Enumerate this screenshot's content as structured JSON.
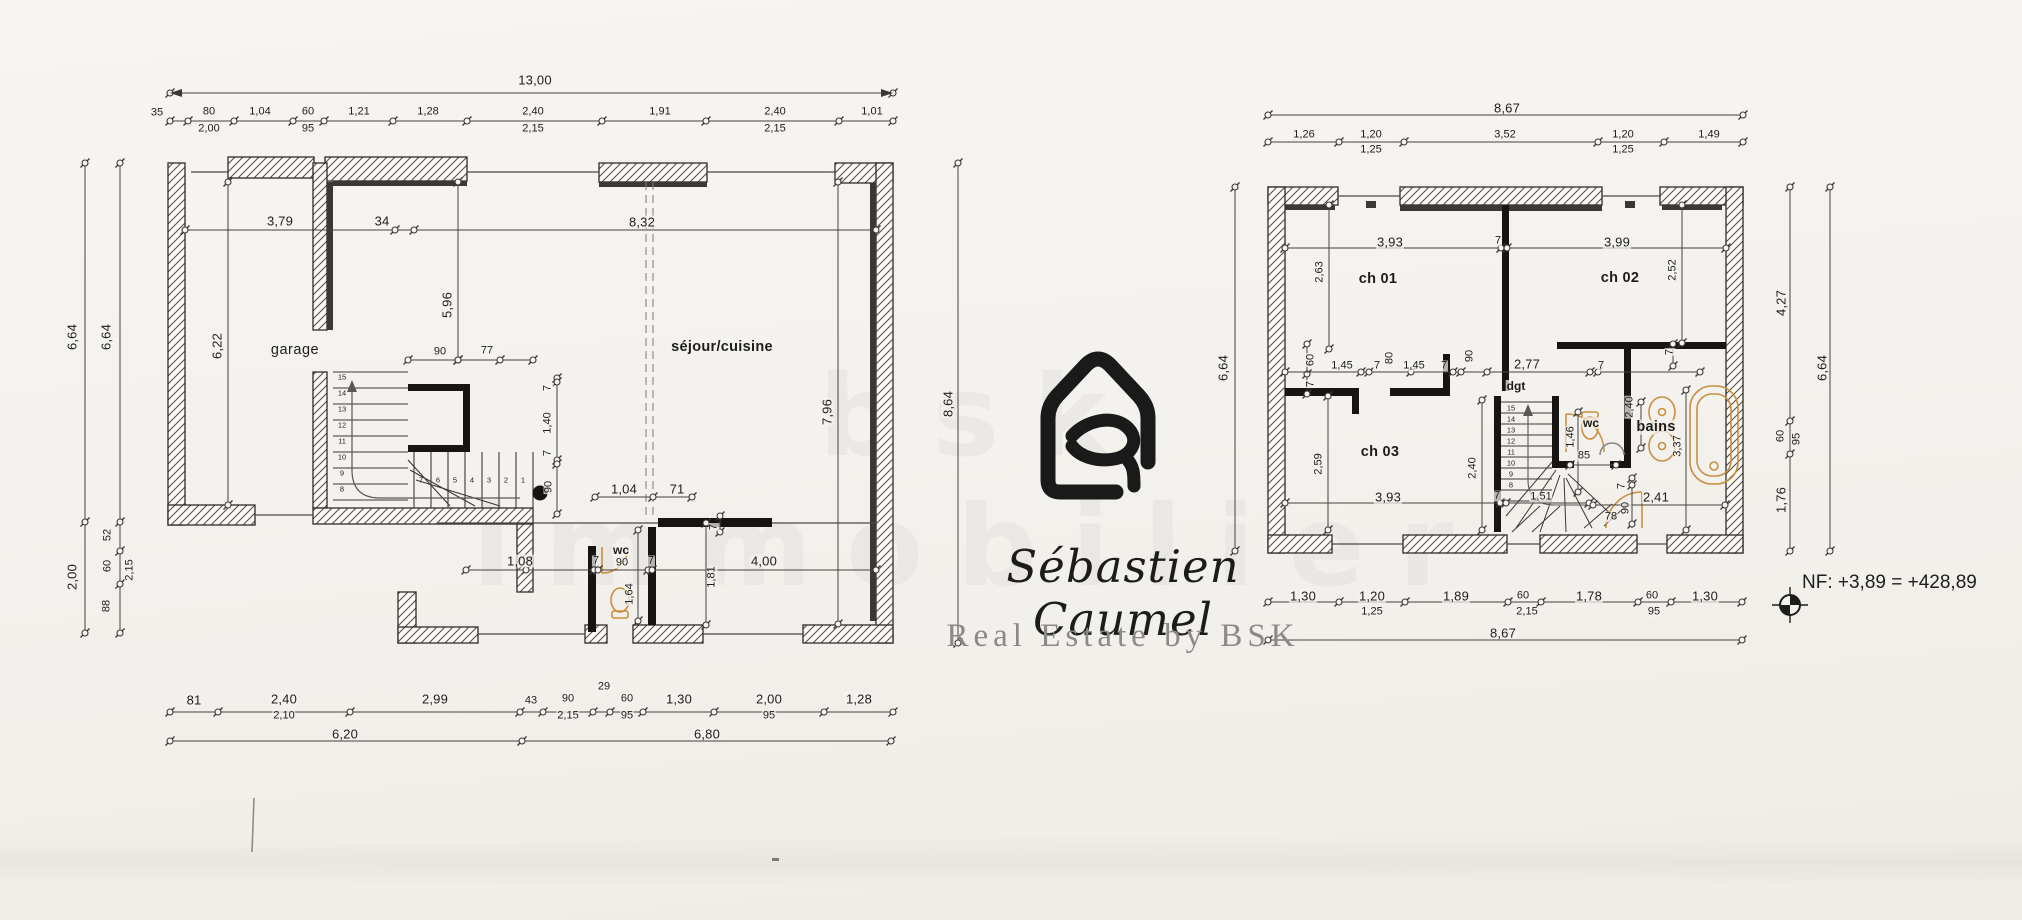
{
  "logo": {
    "name": "Sébastien Caumel",
    "tagline": "Real Estate by BSK"
  },
  "annotations": {
    "level_note": "NF: +3,89 = +428,89"
  },
  "watermark": {
    "text": "bsk immobilier"
  },
  "colors": {
    "paper": "#f4f2ee",
    "ink": "#2e2c29",
    "fixture": "#c98f3f"
  },
  "left_plan": {
    "rooms": [
      "garage",
      "séjour/cuisine",
      "wc"
    ],
    "labels": [
      {
        "t": "13,00",
        "x": 535,
        "y": 80
      },
      {
        "t": "35",
        "x": 157,
        "y": 113,
        "c": "sm"
      },
      {
        "t": "80",
        "x": 209,
        "y": 112,
        "c": "sm"
      },
      {
        "t": "1,04",
        "x": 260,
        "y": 112,
        "c": "sm"
      },
      {
        "t": "60",
        "x": 308,
        "y": 112,
        "c": "sm"
      },
      {
        "t": "1,21",
        "x": 359,
        "y": 112,
        "c": "sm"
      },
      {
        "t": "1,28",
        "x": 428,
        "y": 112,
        "c": "sm"
      },
      {
        "t": "2,40",
        "x": 533,
        "y": 112,
        "c": "sm"
      },
      {
        "t": "1,91",
        "x": 660,
        "y": 112,
        "c": "sm"
      },
      {
        "t": "2,40",
        "x": 775,
        "y": 112,
        "c": "sm"
      },
      {
        "t": "1,01",
        "x": 872,
        "y": 112,
        "c": "sm"
      },
      {
        "t": "2,00",
        "x": 209,
        "y": 129,
        "c": "sm"
      },
      {
        "t": "95",
        "x": 308,
        "y": 129,
        "c": "sm"
      },
      {
        "t": "2,15",
        "x": 533,
        "y": 129,
        "c": "sm"
      },
      {
        "t": "2,15",
        "x": 775,
        "y": 129,
        "c": "sm"
      },
      {
        "t": "6,64",
        "x": 72,
        "y": 337,
        "r": -90
      },
      {
        "t": "6,64",
        "x": 106,
        "y": 337,
        "r": -90
      },
      {
        "t": "2,00",
        "x": 72,
        "y": 577,
        "r": -90
      },
      {
        "t": "52",
        "x": 108,
        "y": 535,
        "r": -90,
        "c": "sm"
      },
      {
        "t": "60",
        "x": 108,
        "y": 566,
        "r": -90,
        "c": "sm"
      },
      {
        "t": "2,15",
        "x": 130,
        "y": 570,
        "r": -90,
        "c": "sm"
      },
      {
        "t": "88",
        "x": 107,
        "y": 606,
        "r": -90,
        "c": "sm"
      },
      {
        "t": "3,79",
        "x": 280,
        "y": 221
      },
      {
        "t": "34",
        "x": 382,
        "y": 221
      },
      {
        "t": "8,32",
        "x": 642,
        "y": 222
      },
      {
        "t": "garage",
        "x": 295,
        "y": 350,
        "c": "roomlt"
      },
      {
        "t": "6,22",
        "x": 217,
        "y": 346,
        "r": -90
      },
      {
        "t": "5,96",
        "x": 447,
        "y": 305,
        "r": -90
      },
      {
        "t": "90",
        "x": 440,
        "y": 352,
        "c": "sm"
      },
      {
        "t": "77",
        "x": 487,
        "y": 351,
        "c": "sm"
      },
      {
        "t": "séjour/cuisine",
        "x": 722,
        "y": 347,
        "c": "room"
      },
      {
        "t": "7",
        "x": 548,
        "y": 388,
        "r": -90,
        "c": "sm"
      },
      {
        "t": "1,40",
        "x": 548,
        "y": 423,
        "r": -90,
        "c": "sm"
      },
      {
        "t": "7",
        "x": 548,
        "y": 453,
        "r": -90,
        "c": "sm"
      },
      {
        "t": "90",
        "x": 549,
        "y": 487,
        "r": -90,
        "c": "sm"
      },
      {
        "t": "7,96",
        "x": 827,
        "y": 412,
        "r": -90
      },
      {
        "t": "1,04",
        "x": 624,
        "y": 489
      },
      {
        "t": "71",
        "x": 677,
        "y": 489
      },
      {
        "t": "7",
        "x": 714,
        "y": 527,
        "r": -90,
        "c": "sm"
      },
      {
        "t": "1,08",
        "x": 520,
        "y": 561
      },
      {
        "t": "7",
        "x": 596,
        "y": 561,
        "c": "sm"
      },
      {
        "t": "90",
        "x": 622,
        "y": 563,
        "c": "sm"
      },
      {
        "t": "7",
        "x": 651,
        "y": 561,
        "c": "sm"
      },
      {
        "t": "wc",
        "x": 621,
        "y": 550,
        "c": "rs"
      },
      {
        "t": "4,00",
        "x": 764,
        "y": 561
      },
      {
        "t": "1,81",
        "x": 712,
        "y": 577,
        "r": -90,
        "c": "sm"
      },
      {
        "t": "1,64",
        "x": 630,
        "y": 594,
        "r": -90,
        "c": "sm"
      },
      {
        "t": "15",
        "x": 342,
        "y": 377,
        "c": "tiny"
      },
      {
        "t": "14",
        "x": 342,
        "y": 393,
        "c": "tiny"
      },
      {
        "t": "13",
        "x": 342,
        "y": 409,
        "c": "tiny"
      },
      {
        "t": "12",
        "x": 342,
        "y": 425,
        "c": "tiny"
      },
      {
        "t": "11",
        "x": 342,
        "y": 441,
        "c": "tiny"
      },
      {
        "t": "10",
        "x": 342,
        "y": 457,
        "c": "tiny"
      },
      {
        "t": "9",
        "x": 342,
        "y": 473,
        "c": "tiny"
      },
      {
        "t": "8",
        "x": 342,
        "y": 489,
        "c": "tiny"
      },
      {
        "t": "1",
        "x": 523,
        "y": 480,
        "c": "tiny"
      },
      {
        "t": "2",
        "x": 506,
        "y": 480,
        "c": "tiny"
      },
      {
        "t": "3",
        "x": 489,
        "y": 480,
        "c": "tiny"
      },
      {
        "t": "4",
        "x": 472,
        "y": 480,
        "c": "tiny"
      },
      {
        "t": "5",
        "x": 455,
        "y": 480,
        "c": "tiny"
      },
      {
        "t": "6",
        "x": 438,
        "y": 480,
        "c": "tiny"
      },
      {
        "t": "7",
        "x": 421,
        "y": 480,
        "c": "tiny"
      },
      {
        "t": "29",
        "x": 604,
        "y": 687,
        "c": "sm"
      },
      {
        "t": "81",
        "x": 194,
        "y": 700
      },
      {
        "t": "2,40",
        "x": 284,
        "y": 699
      },
      {
        "t": "2,99",
        "x": 435,
        "y": 699
      },
      {
        "t": "43",
        "x": 531,
        "y": 701,
        "c": "sm"
      },
      {
        "t": "90",
        "x": 568,
        "y": 699,
        "c": "sm"
      },
      {
        "t": "60",
        "x": 627,
        "y": 699,
        "c": "sm"
      },
      {
        "t": "1,30",
        "x": 679,
        "y": 699
      },
      {
        "t": "2,00",
        "x": 769,
        "y": 699
      },
      {
        "t": "1,28",
        "x": 859,
        "y": 699
      },
      {
        "t": "2,10",
        "x": 284,
        "y": 716,
        "c": "sm"
      },
      {
        "t": "2,15",
        "x": 568,
        "y": 716,
        "c": "sm"
      },
      {
        "t": "95",
        "x": 627,
        "y": 716,
        "c": "sm"
      },
      {
        "t": "95",
        "x": 769,
        "y": 716,
        "c": "sm"
      },
      {
        "t": "6,20",
        "x": 345,
        "y": 734
      },
      {
        "t": "6,80",
        "x": 707,
        "y": 734
      },
      {
        "t": "8,64",
        "x": 948,
        "y": 404,
        "r": -90
      }
    ]
  },
  "right_plan": {
    "rooms": [
      "ch 01",
      "ch 02",
      "ch 03",
      "dgt",
      "wc",
      "bains"
    ],
    "labels": [
      {
        "t": "8,67",
        "x": 1507,
        "y": 108
      },
      {
        "t": "1,26",
        "x": 1304,
        "y": 135,
        "c": "sm"
      },
      {
        "t": "1,20",
        "x": 1371,
        "y": 135,
        "c": "sm"
      },
      {
        "t": "3,52",
        "x": 1505,
        "y": 135,
        "c": "sm"
      },
      {
        "t": "1,20",
        "x": 1623,
        "y": 135,
        "c": "sm"
      },
      {
        "t": "1,49",
        "x": 1709,
        "y": 135,
        "c": "sm"
      },
      {
        "t": "1,25",
        "x": 1371,
        "y": 150,
        "c": "sm"
      },
      {
        "t": "1,25",
        "x": 1623,
        "y": 150,
        "c": "sm"
      },
      {
        "t": "6,64",
        "x": 1223,
        "y": 368,
        "r": -90
      },
      {
        "t": "6,64",
        "x": 1822,
        "y": 368,
        "r": -90
      },
      {
        "t": "4,27",
        "x": 1781,
        "y": 303,
        "r": -90
      },
      {
        "t": "60",
        "x": 1781,
        "y": 436,
        "r": -90,
        "c": "sm"
      },
      {
        "t": "95",
        "x": 1797,
        "y": 439,
        "r": -90,
        "c": "sm"
      },
      {
        "t": "1,76",
        "x": 1781,
        "y": 500,
        "r": -90
      },
      {
        "t": "3,93",
        "x": 1390,
        "y": 242
      },
      {
        "t": "7",
        "x": 1498,
        "y": 241,
        "c": "sm"
      },
      {
        "t": "3,99",
        "x": 1617,
        "y": 242
      },
      {
        "t": "2,63",
        "x": 1320,
        "y": 272,
        "r": -90,
        "c": "sm"
      },
      {
        "t": "2,52",
        "x": 1673,
        "y": 270,
        "r": -90,
        "c": "sm"
      },
      {
        "t": "ch 01",
        "x": 1378,
        "y": 279,
        "c": "room"
      },
      {
        "t": "ch 02",
        "x": 1620,
        "y": 278,
        "c": "room"
      },
      {
        "t": "60",
        "x": 1311,
        "y": 360,
        "r": -90,
        "c": "sm"
      },
      {
        "t": "7",
        "x": 1311,
        "y": 384,
        "r": -90,
        "c": "sm"
      },
      {
        "t": "1,45",
        "x": 1342,
        "y": 366,
        "c": "sm"
      },
      {
        "t": "7",
        "x": 1377,
        "y": 366,
        "c": "sm"
      },
      {
        "t": "80",
        "x": 1390,
        "y": 358,
        "r": -90,
        "c": "sm"
      },
      {
        "t": "1,45",
        "x": 1414,
        "y": 366,
        "c": "sm"
      },
      {
        "t": "7",
        "x": 1444,
        "y": 366,
        "c": "sm"
      },
      {
        "t": "90",
        "x": 1470,
        "y": 356,
        "r": -90,
        "c": "sm"
      },
      {
        "t": "2,77",
        "x": 1527,
        "y": 364
      },
      {
        "t": "7",
        "x": 1601,
        "y": 366,
        "c": "sm"
      },
      {
        "t": "7",
        "x": 1670,
        "y": 352,
        "r": -90,
        "c": "sm"
      },
      {
        "t": "dgt",
        "x": 1516,
        "y": 386,
        "c": "rs"
      },
      {
        "t": "ch 03",
        "x": 1380,
        "y": 452,
        "c": "room"
      },
      {
        "t": "2,59",
        "x": 1319,
        "y": 464,
        "r": -90,
        "c": "sm"
      },
      {
        "t": "2,40",
        "x": 1473,
        "y": 468,
        "r": -90,
        "c": "sm"
      },
      {
        "t": "wc",
        "x": 1591,
        "y": 423,
        "c": "rs"
      },
      {
        "t": "bains",
        "x": 1656,
        "y": 427,
        "c": "room"
      },
      {
        "t": "1,46",
        "x": 1571,
        "y": 437,
        "r": -90,
        "c": "sm"
      },
      {
        "t": "85",
        "x": 1584,
        "y": 456,
        "c": "sm"
      },
      {
        "t": "2,40",
        "x": 1630,
        "y": 407,
        "r": -90,
        "c": "sm"
      },
      {
        "t": "3,37",
        "x": 1678,
        "y": 446,
        "r": -90,
        "c": "sm"
      },
      {
        "t": "3,93",
        "x": 1388,
        "y": 497
      },
      {
        "t": "7",
        "x": 1497,
        "y": 496,
        "c": "sm"
      },
      {
        "t": "1,51",
        "x": 1541,
        "y": 497,
        "c": "sm"
      },
      {
        "t": "2,41",
        "x": 1656,
        "y": 497
      },
      {
        "t": "78",
        "x": 1611,
        "y": 517,
        "c": "sm"
      },
      {
        "t": "90",
        "x": 1626,
        "y": 508,
        "r": -90,
        "c": "sm"
      },
      {
        "t": "7",
        "x": 1622,
        "y": 486,
        "r": -90,
        "c": "sm"
      },
      {
        "t": "15",
        "x": 1511,
        "y": 408,
        "c": "tiny"
      },
      {
        "t": "14",
        "x": 1511,
        "y": 419,
        "c": "tiny"
      },
      {
        "t": "13",
        "x": 1511,
        "y": 430,
        "c": "tiny"
      },
      {
        "t": "12",
        "x": 1511,
        "y": 441,
        "c": "tiny"
      },
      {
        "t": "11",
        "x": 1511,
        "y": 452,
        "c": "tiny"
      },
      {
        "t": "10",
        "x": 1511,
        "y": 463,
        "c": "tiny"
      },
      {
        "t": "9",
        "x": 1511,
        "y": 474,
        "c": "tiny"
      },
      {
        "t": "8",
        "x": 1511,
        "y": 485,
        "c": "tiny"
      },
      {
        "t": "1,30",
        "x": 1303,
        "y": 596
      },
      {
        "t": "1,20",
        "x": 1372,
        "y": 596
      },
      {
        "t": "1,89",
        "x": 1456,
        "y": 596
      },
      {
        "t": "60",
        "x": 1523,
        "y": 596,
        "c": "sm"
      },
      {
        "t": "1,78",
        "x": 1589,
        "y": 596
      },
      {
        "t": "60",
        "x": 1652,
        "y": 596,
        "c": "sm"
      },
      {
        "t": "1,30",
        "x": 1705,
        "y": 596
      },
      {
        "t": "1,25",
        "x": 1372,
        "y": 612,
        "c": "sm"
      },
      {
        "t": "2,15",
        "x": 1527,
        "y": 612,
        "c": "sm"
      },
      {
        "t": "95",
        "x": 1654,
        "y": 612,
        "c": "sm"
      },
      {
        "t": "8,67",
        "x": 1503,
        "y": 633
      }
    ]
  }
}
